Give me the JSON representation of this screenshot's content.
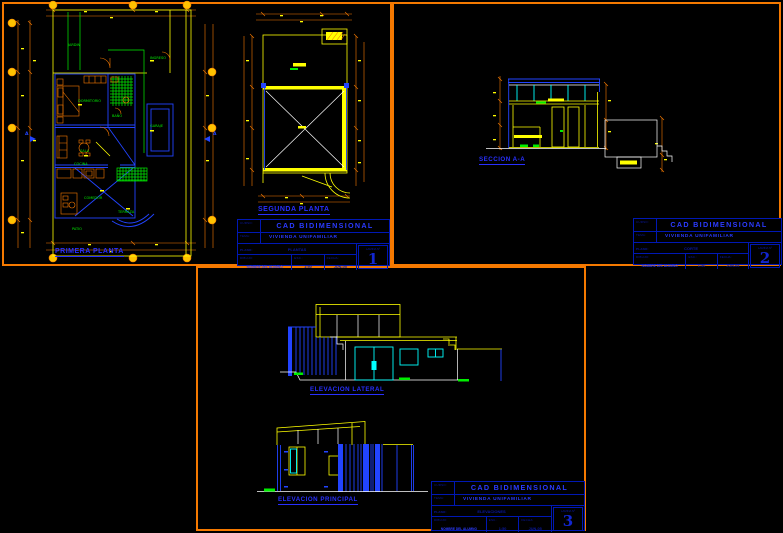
{
  "colors": {
    "background": "#000000",
    "sheet_border": "#F57900",
    "cad_yellow": "#FFFF00",
    "cad_blue": "#2244FF",
    "cad_green": "#00EE00",
    "cad_cyan": "#00FFFF",
    "cad_white": "#FFFFFF",
    "label_blue": "#2830FF",
    "titleblock_line": "#0018B4"
  },
  "section_marker": "A",
  "sheets": [
    {
      "number": "1",
      "drawings": [
        {
          "label": "PRIMERA PLANTA",
          "room_labels": [
            "JARDIN",
            "INGRESO",
            "DORMITORIO",
            "BAÑO",
            "GARAJE",
            "SALA",
            "COCINA",
            "COMEDOR",
            "TERRAZA",
            "PATIO"
          ]
        },
        {
          "label": "SEGUNDA PLANTA"
        }
      ],
      "title_block": {
        "curso_label": "CURSO:",
        "curso": "CAD BIDIMENSIONAL",
        "tema_label": "TEMA:",
        "tema": "VIVIENDA UNIFAMILIAR",
        "plano_label": "PLANO:",
        "plano": "PLANTAS",
        "dibujo_label": "DIBUJO:",
        "dibujo": "NOMBRE DEL ALUMNO",
        "esc_label": "ESC.:",
        "esc": "1:50",
        "fecha_label": "FECHA:",
        "fecha": "JUN-05",
        "lamina_label": "LAMINA Nº",
        "lamina": "1"
      }
    },
    {
      "number": "2",
      "drawings": [
        {
          "label": "SECCION A-A"
        }
      ],
      "title_block": {
        "curso_label": "CURSO:",
        "curso": "CAD BIDIMENSIONAL",
        "tema_label": "TEMA:",
        "tema": "VIVIENDA UNIFAMILIAR",
        "plano_label": "PLANO:",
        "plano": "CORTE",
        "dibujo_label": "DIBUJO:",
        "dibujo": "NOMBRE DEL ALUMNO",
        "esc_label": "ESC.:",
        "esc": "1:50",
        "fecha_label": "FECHA:",
        "fecha": "JUN-05",
        "lamina_label": "LAMINA Nº",
        "lamina": "2"
      }
    },
    {
      "number": "3",
      "drawings": [
        {
          "label": "ELEVACION LATERAL"
        },
        {
          "label": "ELEVACION PRINCIPAL"
        }
      ],
      "title_block": {
        "curso_label": "CURSO:",
        "curso": "CAD BIDIMENSIONAL",
        "tema_label": "TEMA:",
        "tema": "VIVIENDA UNIFAMILIAR",
        "plano_label": "PLANO:",
        "plano": "ELEVACIONES",
        "dibujo_label": "DIBUJO:",
        "dibujo": "NOMBRE DEL ALUMNO",
        "esc_label": "ESC.:",
        "esc": "1:50",
        "fecha_label": "FECHA:",
        "fecha": "JUN-05",
        "lamina_label": "LAMINA Nº",
        "lamina": "3"
      }
    }
  ]
}
